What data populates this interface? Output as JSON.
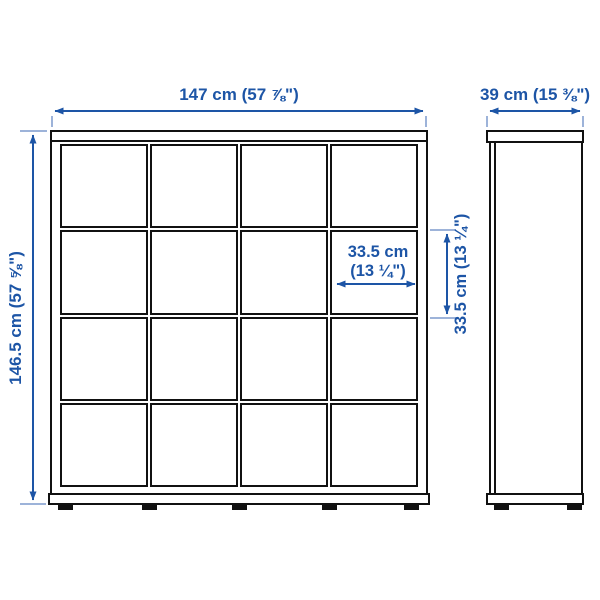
{
  "structure": {
    "front_view": {
      "rows": 4,
      "columns": 4,
      "cells": 16
    },
    "views": [
      "front",
      "side"
    ]
  },
  "labels": {
    "overall_width": "147 cm (57 ⅞\")",
    "overall_depth": "39 cm (15 ⅜\")",
    "overall_height": "146.5 cm (57 ⅝\")",
    "cell_width_line1": "33.5 cm",
    "cell_width_line2": "(13 ¼\")",
    "cell_height": "33.5 cm (13 ¼\")"
  },
  "colors": {
    "dimension_blue": "#1d55a6",
    "extension_blue": "#9db3d9",
    "outline_black": "#111111",
    "background": "#ffffff"
  }
}
